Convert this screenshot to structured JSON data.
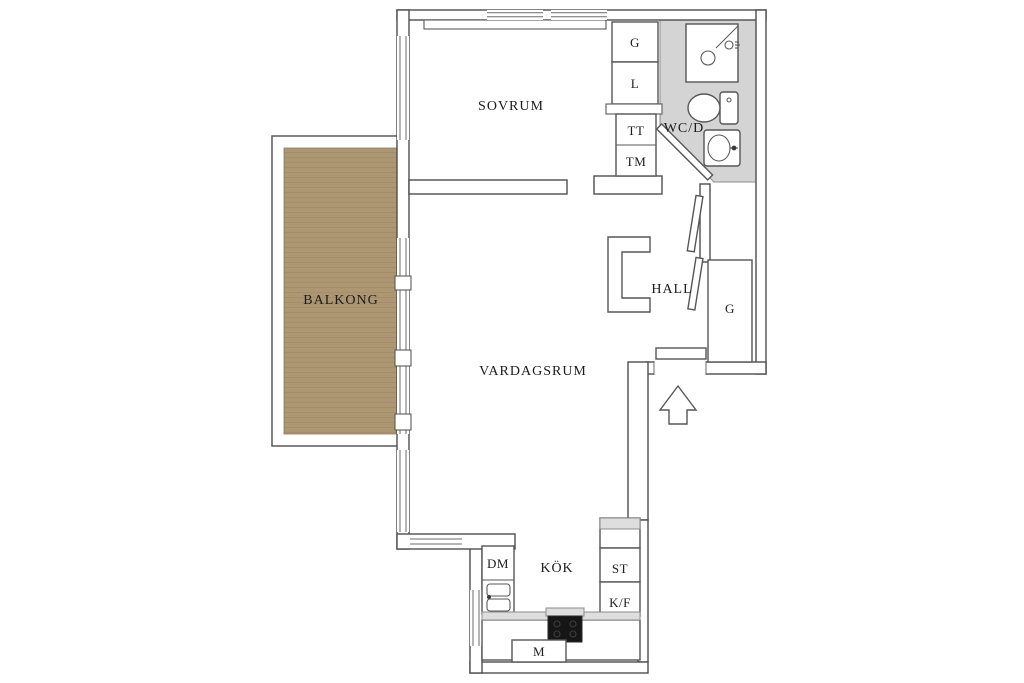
{
  "rooms": {
    "sovrum": "SOVRUM",
    "wc": "WC/D",
    "hall": "HALL",
    "balcony": "BALKONG",
    "living": "VARDAGSRUM",
    "kitchen": "KÖK"
  },
  "cabinets": {
    "g_top": "G",
    "l": "L",
    "tt": "TT",
    "tm": "TM",
    "hall_g": "G",
    "dm": "DM",
    "st": "ST",
    "kf": "K/F",
    "m": "M"
  },
  "icons": {
    "entrance": "up-arrow",
    "shower": "shower-cabin",
    "toilet": "toilet",
    "basin": "washbasin",
    "kitchen_sink": "double-sink",
    "stove": "cooktop"
  },
  "colors": {
    "wall_line": "#4e4e4e",
    "wood": "#ad9672",
    "wood_stripe": "#9d8763",
    "wc_floor": "#d4d4d4",
    "counter": "#dedede",
    "stove": "#161616",
    "text": "#1c1c1c"
  }
}
